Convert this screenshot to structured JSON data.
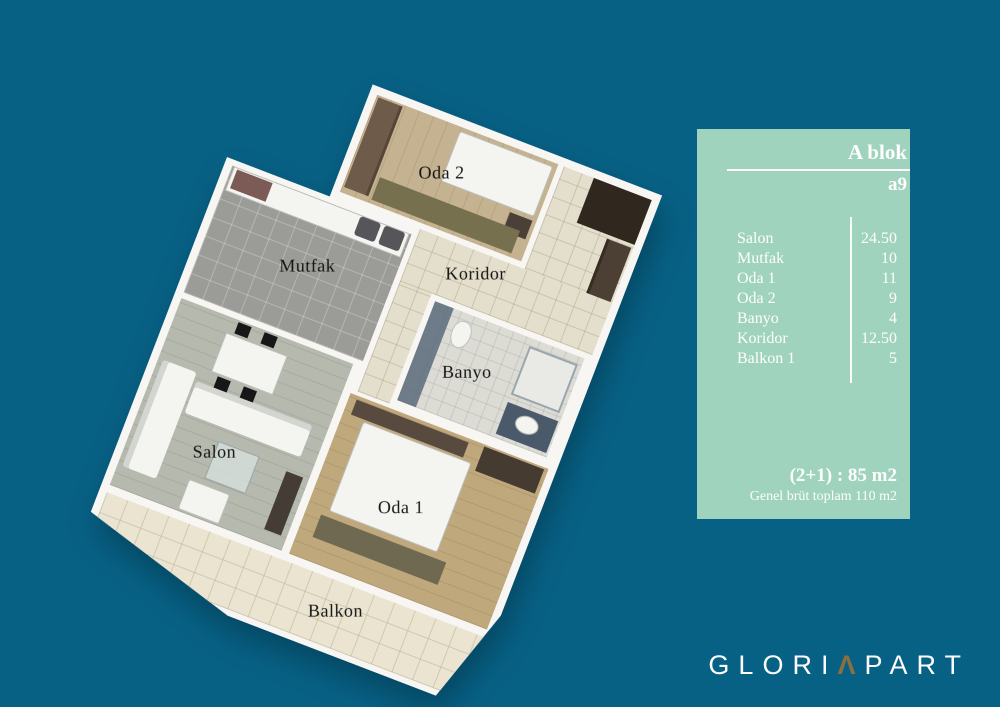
{
  "colors": {
    "background": "#076185",
    "panel": "#9fd3bd",
    "panel_text": "#fdfefd",
    "plan_label_text": "#141414",
    "logo_text": "#fbfbfb",
    "logo_caret": "#8d6e3e"
  },
  "floorplan": {
    "labels": [
      {
        "id": "salon",
        "text": "Salon"
      },
      {
        "id": "mutfak",
        "text": "Mutfak"
      },
      {
        "id": "koridor",
        "text": "Koridor"
      },
      {
        "id": "banyo",
        "text": "Banyo"
      },
      {
        "id": "oda1",
        "text": "Oda 1"
      },
      {
        "id": "oda2",
        "text": "Oda 2"
      },
      {
        "id": "balkon",
        "text": "Balkon"
      }
    ]
  },
  "info_panel": {
    "block_title": "A blok",
    "unit": "a9",
    "rooms": [
      {
        "name": "Salon",
        "area": "24.50"
      },
      {
        "name": "Mutfak",
        "area": "10"
      },
      {
        "name": "Oda 1",
        "area": "11"
      },
      {
        "name": "Oda 2",
        "area": "9"
      },
      {
        "name": "Banyo",
        "area": "4"
      },
      {
        "name": "Koridor",
        "area": "12.50"
      },
      {
        "name": "Balkon 1",
        "area": "5"
      }
    ],
    "summary_main": "(2+1) : 85 m2",
    "summary_sub": "Genel brüt toplam 110 m2"
  },
  "logo": {
    "prefix": "GLORI",
    "caret": "Λ",
    "suffix": "PART"
  }
}
